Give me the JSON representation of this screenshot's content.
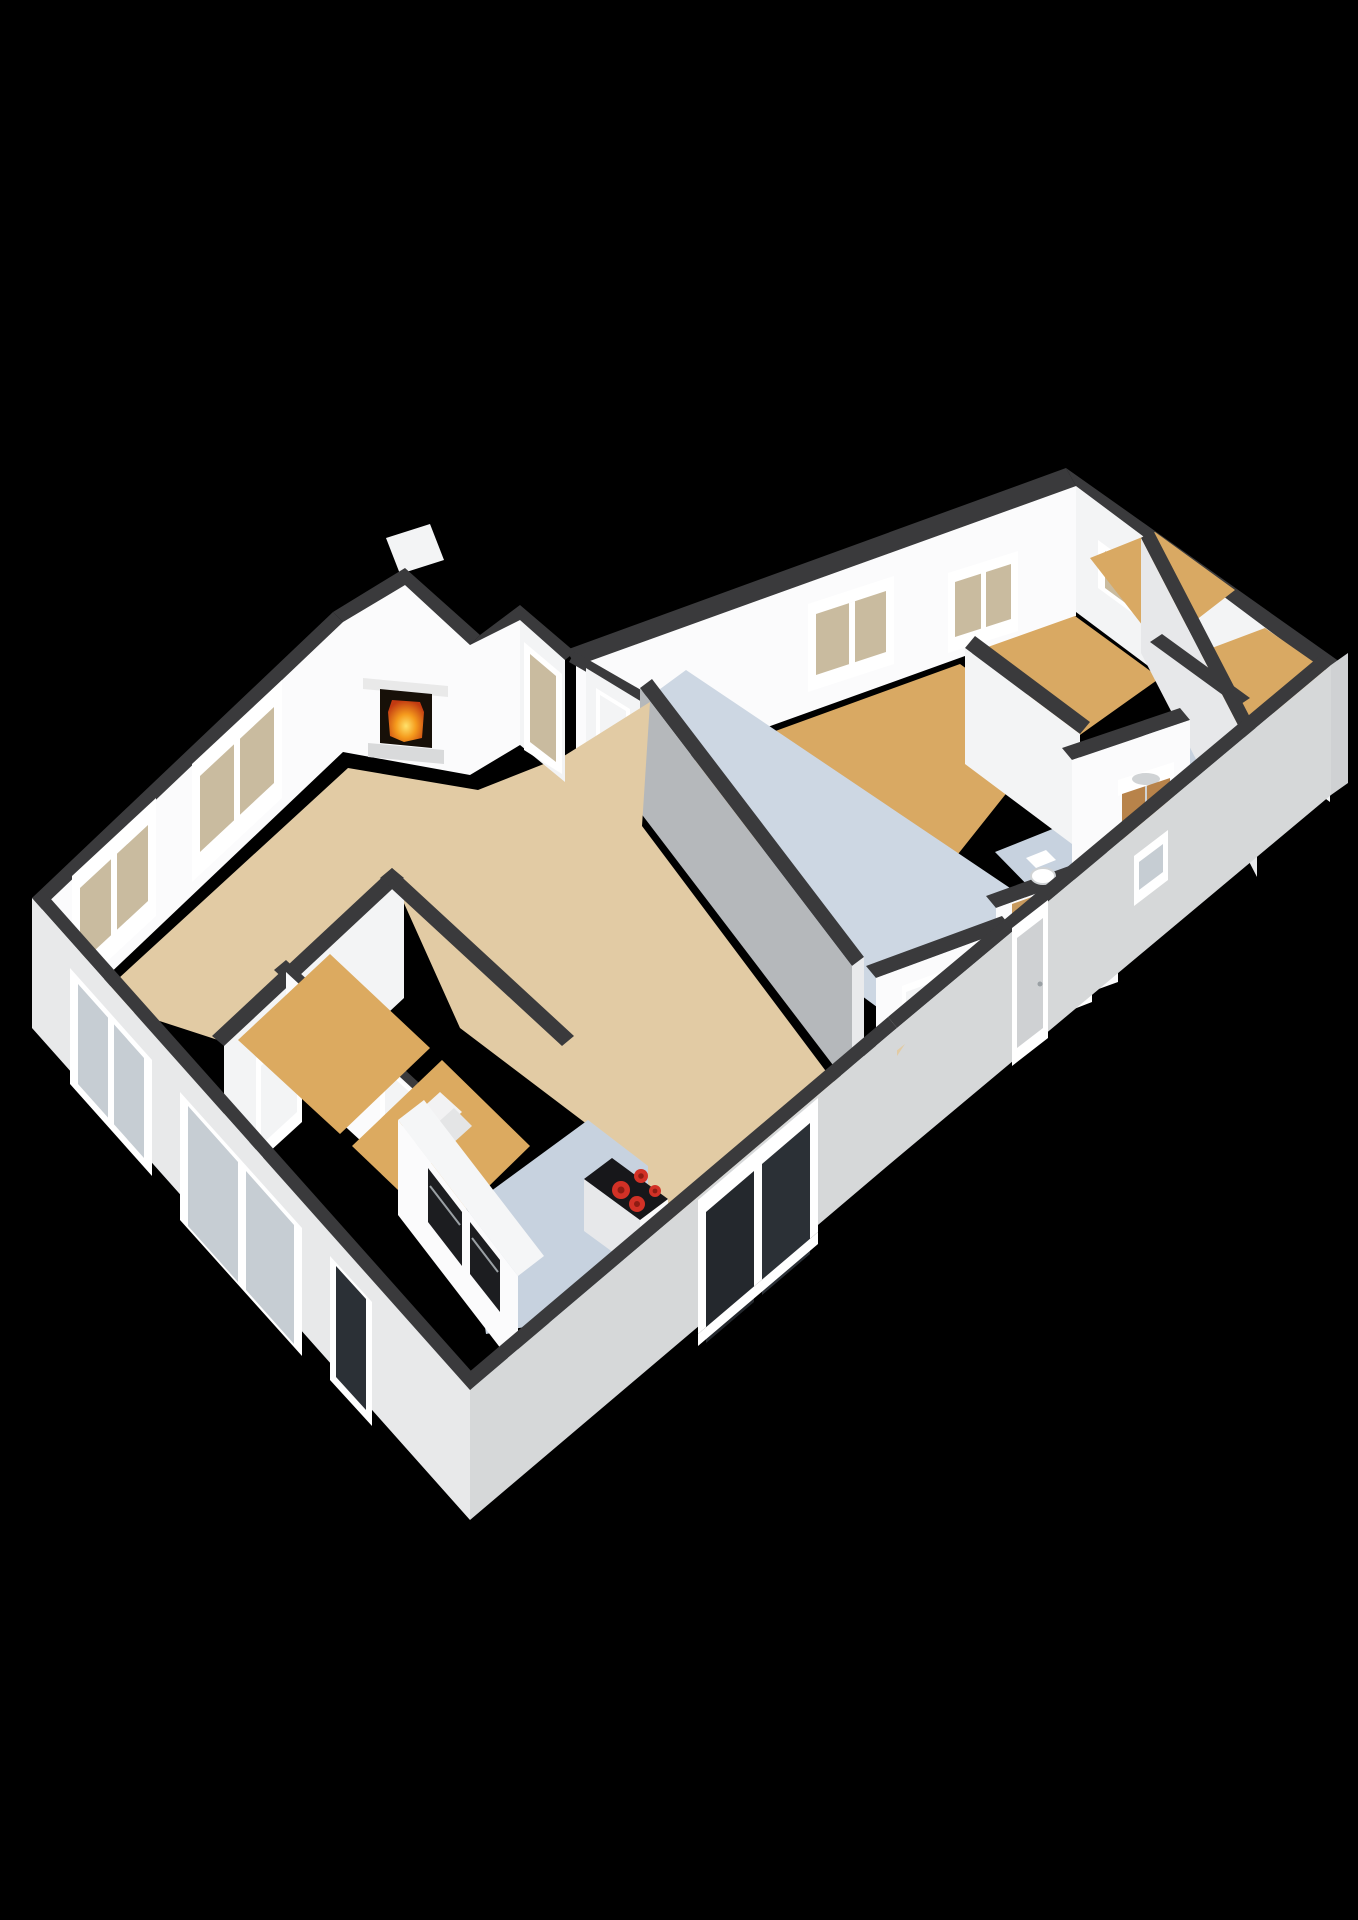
{
  "meta": {
    "title": "3D axonometric floor plan render",
    "render_style": "cutaway 3d floor plan, no labels",
    "background": "#000000"
  },
  "palette": {
    "bg": "#000000",
    "wallTop": "#3a3a3c",
    "wallFaceBright": "#fbfbfc",
    "wallFaceLight": "#f3f4f5",
    "wallFaceShaded": "#e7e8ea",
    "wallFaceGray": "#b5b8bb",
    "jambLight": "#e9eaec",
    "extWallLight": "#e8e9ea",
    "extWallMid": "#d6d8d9",
    "extWallDark": "#cfd1d3",
    "floorLiving": "#e2cba4",
    "floorWood": "#d9a963",
    "floorWoodEntry": "#dcaa60",
    "floorBlue": "#c7d2df",
    "floorBlueLight": "#cdd7e3",
    "glassBeige": "#c9bb9f",
    "glassCool": "#c6cdd3",
    "glassDark": "#24282d",
    "glassDark2": "#2b3036",
    "frameWhite": "#ffffff",
    "fireboxDark": "#171008",
    "fireOuter": "#c23a11",
    "fireMid": "#f59b1d",
    "fireInner": "#ffe26b",
    "hearth": "#d9dadb",
    "mantel": "#e9e9e9",
    "stoveBlack": "#17171a",
    "burnerRed": "#d23126",
    "burnerCore": "#8e1c13",
    "cabinetWhite": "#f5f6f7",
    "applianceBlack": "#1c1d20",
    "vanityWood": "#b8834a",
    "doorWood": "#c89a5e",
    "fixtureWhite": "#ffffff",
    "fixtureShadow": "#d0d3d5",
    "stepLight": "#f2f2f3",
    "stepShade": "#e4e5e6",
    "boilerWhite": "#f7f8f9",
    "handleGray": "#9aa0a4"
  },
  "rooms": [
    {
      "name": "living-room",
      "floor": "floorLiving",
      "features": [
        "fireplace",
        "bay-window"
      ]
    },
    {
      "name": "kitchen",
      "floor": "floorBlue",
      "features": [
        "cabinet-run",
        "built-in-ovens",
        "cooktop-island",
        "window"
      ]
    },
    {
      "name": "entry-hall",
      "floor": "floorWoodEntry",
      "features": [
        "steps",
        "wall-boiler",
        "doors"
      ]
    },
    {
      "name": "hallway",
      "floor": "floorBlueLight",
      "features": [
        "doors"
      ]
    },
    {
      "name": "bedroom-1",
      "floor": "floorWood",
      "features": [
        "window",
        "door"
      ]
    },
    {
      "name": "bedroom-2",
      "floor": "floorWood",
      "features": [
        "window"
      ]
    },
    {
      "name": "storage-room-1",
      "floor": "floorWood",
      "features": [
        "small-window"
      ]
    },
    {
      "name": "storage-room-2",
      "floor": "floorWood",
      "features": [
        "small-window"
      ]
    },
    {
      "name": "bathroom",
      "floor": "floorBlue",
      "features": [
        "vanity-sink",
        "wood-door"
      ]
    },
    {
      "name": "toilet",
      "floor": "floorBlue",
      "features": [
        "toilet",
        "corner-sink"
      ]
    }
  ],
  "fixtures": {
    "fireplace": {
      "state": "lit"
    },
    "cooktop": {
      "burners": 4
    },
    "built_in_ovens": 2,
    "bathroom_vanity_sink": 1,
    "toilet": 1,
    "entry_steps": 2,
    "wall_boiler": 1
  }
}
